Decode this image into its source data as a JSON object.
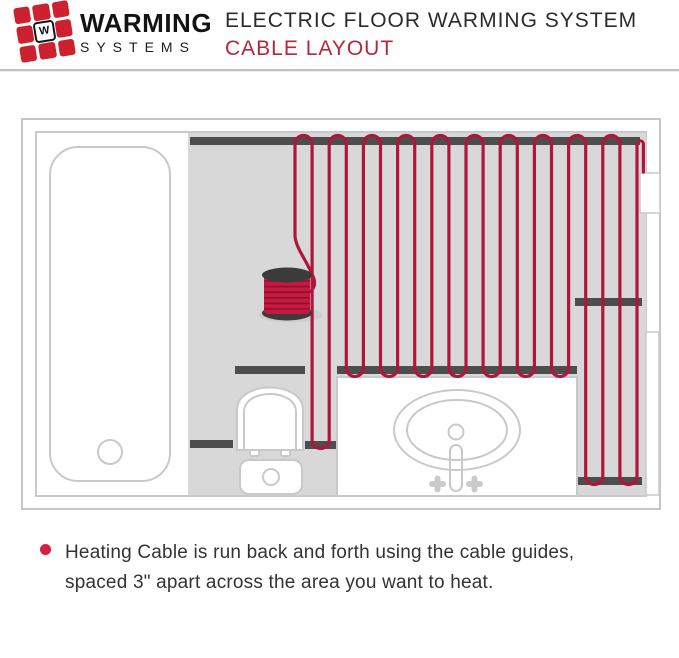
{
  "header": {
    "logo": {
      "mark_letter": "W",
      "brand_top": "WARMING",
      "brand_bottom": "SYSTEMS"
    },
    "title_line1": "ELECTRIC FLOOR WARMING SYSTEM",
    "title_line2": "CABLE LAYOUT"
  },
  "footnote": {
    "line1": "Heating Cable is run back and forth using the cable guides,",
    "line2": "spaced 3\" apart across the area you want to heat."
  },
  "colors": {
    "cable_red": "#b0163c",
    "spool_red": "#c7183f",
    "accent_red": "#b5283c",
    "logo_red": "#ce2130",
    "bullet_red": "#d3203f",
    "guide_gray": "#4d4d4d",
    "floor_gray": "#d8d8d8",
    "outline_gray": "#c9c9c9"
  }
}
